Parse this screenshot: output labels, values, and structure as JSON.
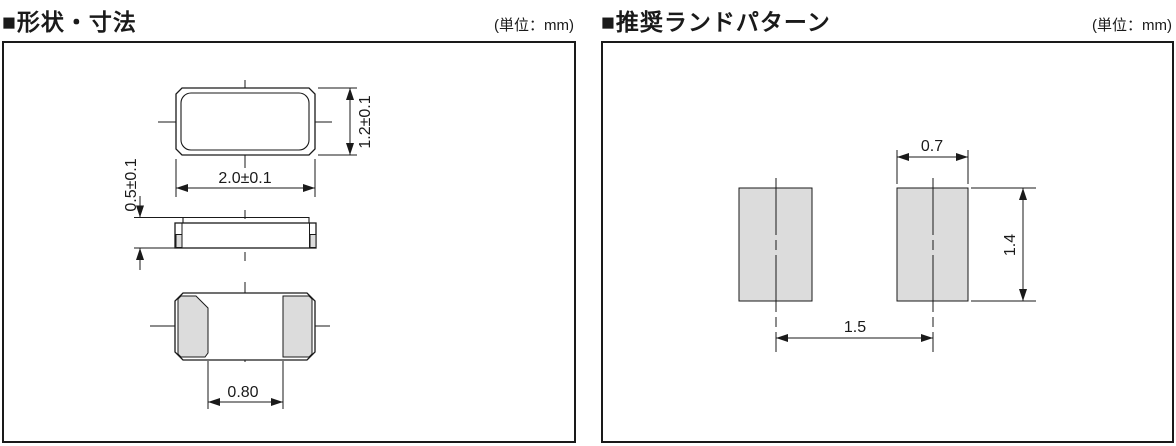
{
  "theme": {
    "line_color": "#1a1a1a",
    "pad_fill": "#dcdcdc",
    "background": "#ffffff"
  },
  "left_panel": {
    "title": "■形状・寸法",
    "unit": "(単位：mm)",
    "dimensions": {
      "body_width": "2.0±0.1",
      "body_height": "1.2±0.1",
      "body_thickness": "0.5±0.1",
      "terminal_gap": "0.80"
    }
  },
  "right_panel": {
    "title": "■推奨ランドパターン",
    "unit": "(単位：mm)",
    "dimensions": {
      "pad_width": "0.7",
      "pad_height": "1.4",
      "pad_pitch": "1.5"
    }
  }
}
